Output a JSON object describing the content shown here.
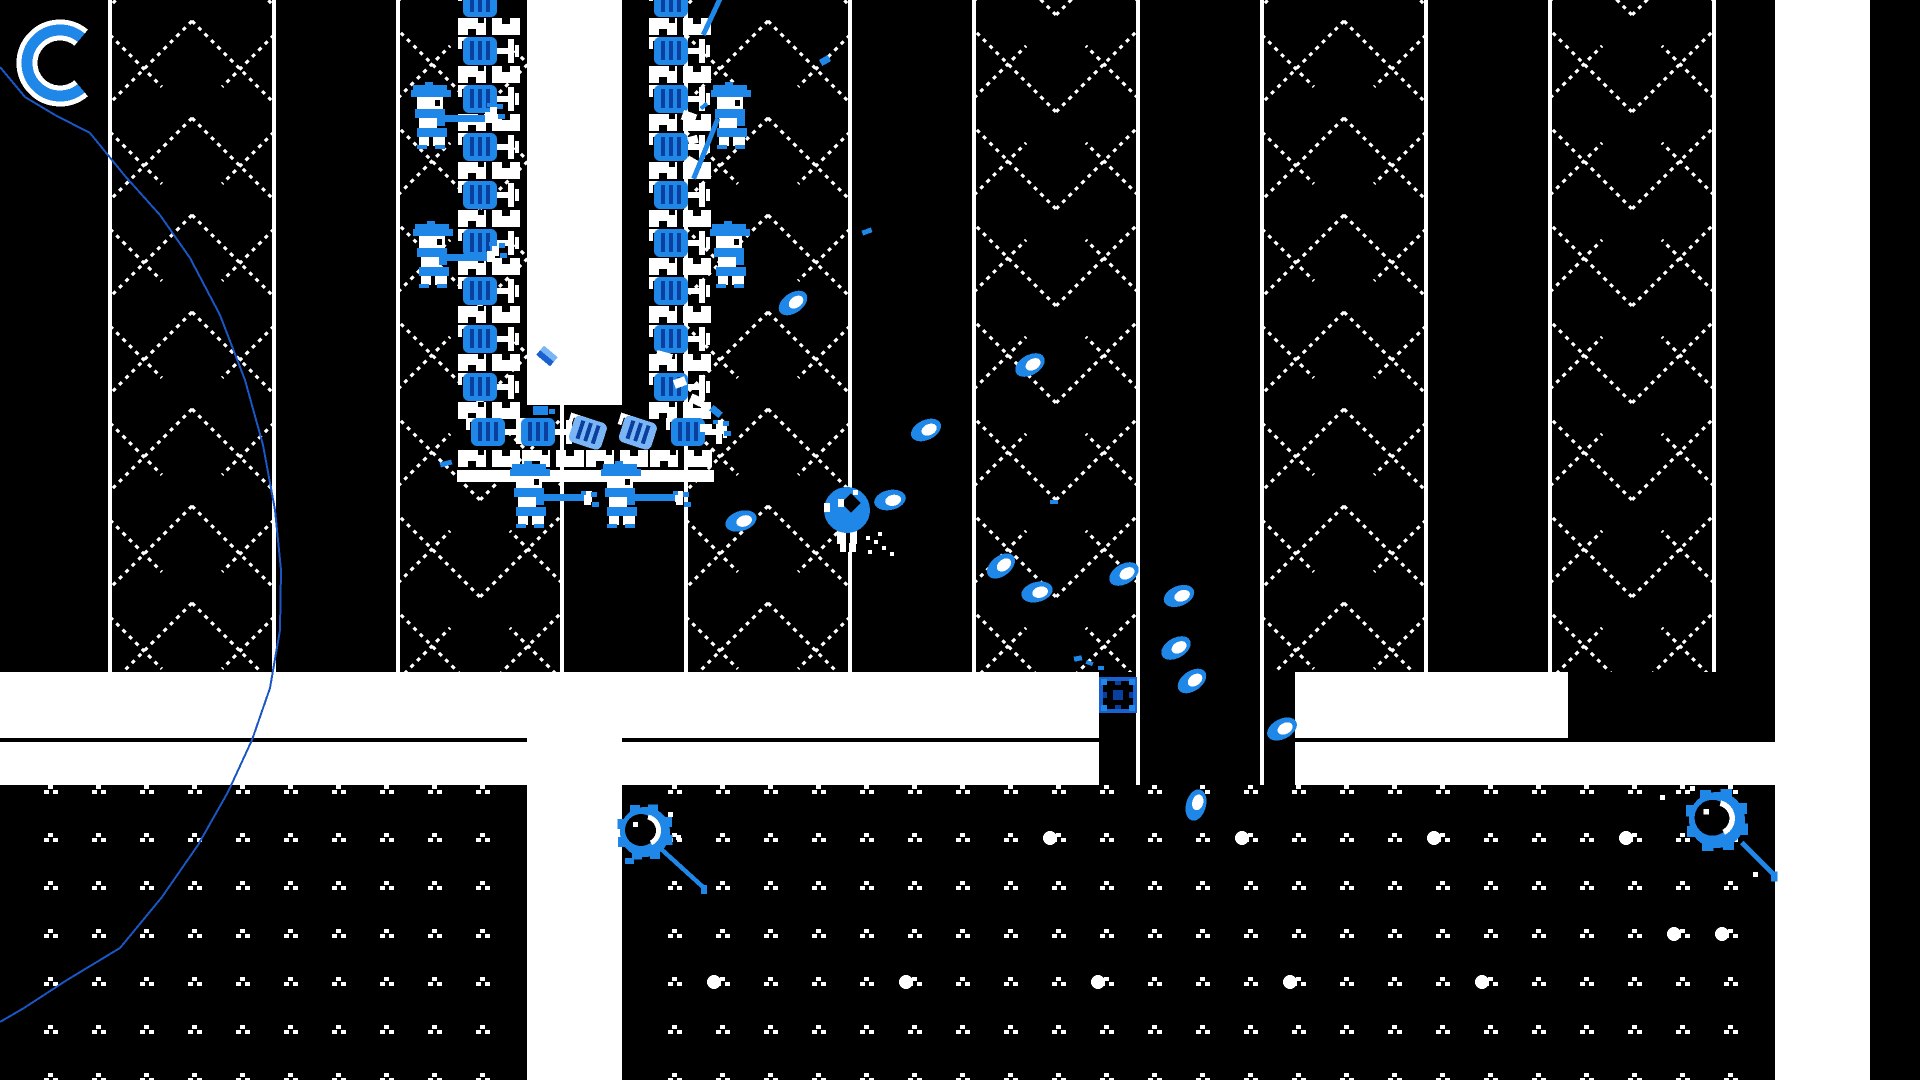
{
  "scene": {
    "width": 1920,
    "height": 1080,
    "bg": "#000000",
    "title": "pixel-art shooter game scene"
  },
  "palette": {
    "white": "#ffffff",
    "black": "#000000",
    "blue": "#1e87e8",
    "blue_dark": "#0a3f9e",
    "blue_mid": "#1861cf",
    "blue_light": "#7ab5f5",
    "line_blue": "#1a56c4"
  },
  "hud": {
    "dash_ring": {
      "cx": 60,
      "cy": 63,
      "r": 33,
      "a1": 50,
      "a2": 310,
      "outer_w": 21,
      "inner_w": 11
    }
  },
  "trajectory": {
    "points": [
      [
        0,
        67
      ],
      [
        25,
        97
      ],
      [
        55,
        115
      ],
      [
        90,
        133
      ],
      [
        125,
        176
      ],
      [
        160,
        215
      ],
      [
        190,
        258
      ],
      [
        220,
        315
      ],
      [
        245,
        380
      ],
      [
        263,
        445
      ],
      [
        275,
        510
      ],
      [
        281,
        570
      ],
      [
        280,
        630
      ],
      [
        270,
        688
      ],
      [
        252,
        740
      ],
      [
        228,
        792
      ],
      [
        198,
        845
      ],
      [
        162,
        897
      ],
      [
        120,
        948
      ],
      [
        67,
        980
      ],
      [
        24,
        1008
      ],
      [
        0,
        1022
      ]
    ]
  },
  "columns": {
    "width": 164,
    "bottom": 672,
    "tile_h": 97,
    "edge_w": 4,
    "items": [
      {
        "x": 110,
        "dir": "up",
        "eb": [
          672,
          672
        ]
      },
      {
        "x": 398,
        "dir": "down",
        "eb": [
          672,
          672
        ]
      },
      {
        "x": 686,
        "dir": "up",
        "eb": [
          672,
          672
        ]
      },
      {
        "x": 974,
        "dir": "down",
        "eb": [
          672,
          785
        ]
      },
      {
        "x": 1262,
        "dir": "up",
        "eb": [
          785,
          672
        ]
      },
      {
        "x": 1550,
        "dir": "down",
        "eb": [
          672,
          672
        ]
      }
    ]
  },
  "band": {
    "row1": {
      "y": 672,
      "h": 66,
      "segments": [
        [
          0,
          1099
        ],
        [
          1295,
          1568
        ]
      ]
    },
    "row2": {
      "y": 742,
      "h": 43,
      "segments": [
        [
          0,
          1099
        ],
        [
          1295,
          1870
        ]
      ]
    }
  },
  "corridors": [
    {
      "x": 527,
      "y": 672,
      "w": 95,
      "h": 408
    },
    {
      "x": 1775,
      "y": 0,
      "w": 95,
      "h": 1080
    }
  ],
  "ground": {
    "top": 785,
    "blocks": [
      [
        0,
        528
      ],
      [
        623,
        1776
      ]
    ],
    "pitch": 48,
    "x_phase": 2,
    "rows": [
      790,
      838,
      886,
      934,
      982,
      1030,
      1078
    ],
    "big_dots": [
      [
        1050,
        838
      ],
      [
        1242,
        838
      ],
      [
        1434,
        838
      ],
      [
        1626,
        838
      ],
      [
        714,
        982
      ],
      [
        906,
        982
      ],
      [
        1098,
        982
      ],
      [
        1290,
        982
      ],
      [
        1482,
        982
      ],
      [
        1674,
        934
      ],
      [
        1722,
        934
      ]
    ]
  },
  "fort": {
    "strip": {
      "x": 527,
      "y": 0,
      "w": 95,
      "h": 405
    },
    "walls": [
      {
        "x": 458,
        "units": 8
      },
      {
        "x": 649,
        "units": 8
      }
    ],
    "unit": {
      "period": 48,
      "castle_dy": -19,
      "dome_y0": 37
    },
    "bottom_row": {
      "y": 418,
      "turrets": [
        {
          "x": 466
        },
        {
          "x": 516
        },
        {
          "x": 566,
          "damaged": true
        },
        {
          "x": 616,
          "damaged": true
        },
        {
          "x": 666
        }
      ]
    },
    "base": {
      "castle_y": 450,
      "castle_xs": [
        458,
        522,
        586,
        650
      ],
      "bar": {
        "x": 457,
        "y": 470,
        "w": 257,
        "h": 12
      }
    },
    "knife": {
      "x": 538,
      "y": 350,
      "rot": 40
    }
  },
  "soldiers": [
    {
      "x": 411,
      "y": 85,
      "rifle": true
    },
    {
      "x": 413,
      "y": 224,
      "rifle": true
    },
    {
      "x": 510,
      "y": 464,
      "rifle": true
    },
    {
      "x": 601,
      "y": 464,
      "rifle": true
    },
    {
      "x": 711,
      "y": 85,
      "rifle": false
    },
    {
      "x": 710,
      "y": 224,
      "rifle": false
    }
  ],
  "muzzle_flashes": [
    [
      490,
      107
    ],
    [
      492,
      246
    ],
    [
      584,
      495
    ],
    [
      676,
      495
    ],
    [
      716,
      424
    ]
  ],
  "projectiles": [
    [
      793,
      303,
      -35
    ],
    [
      1030,
      365,
      -30
    ],
    [
      926,
      430,
      -25
    ],
    [
      890,
      500,
      -12
    ],
    [
      1001,
      566,
      -38
    ],
    [
      1037,
      592,
      -15
    ],
    [
      1124,
      574,
      -30
    ],
    [
      1179,
      596,
      -22
    ],
    [
      1176,
      648,
      -30
    ],
    [
      1192,
      681,
      -35
    ],
    [
      1282,
      729,
      -28
    ],
    [
      1196,
      805,
      -75
    ],
    [
      741,
      521,
      -18
    ]
  ],
  "streaks": [
    {
      "x": 716,
      "y": -2,
      "len": 40,
      "rot": 25
    },
    {
      "x": 714,
      "y": 118,
      "len": 65,
      "rot": 22
    }
  ],
  "debris_white": [
    [
      682,
      112,
      14,
      10,
      20
    ],
    [
      688,
      136,
      10,
      8,
      -15
    ],
    [
      686,
      158,
      12,
      9,
      30
    ],
    [
      656,
      352,
      16,
      10,
      15
    ],
    [
      674,
      378,
      12,
      9,
      -20
    ],
    [
      690,
      396,
      14,
      9,
      25
    ],
    [
      700,
      424,
      12,
      8,
      0
    ],
    [
      718,
      420,
      8,
      8,
      45
    ]
  ],
  "debris_blue": [
    [
      820,
      57,
      10,
      7,
      -30
    ],
    [
      862,
      229,
      10,
      5,
      -20
    ],
    [
      440,
      461,
      12,
      5,
      -15
    ],
    [
      533,
      406,
      15,
      9,
      0
    ],
    [
      549,
      409,
      6,
      5,
      0
    ],
    [
      1050,
      500,
      8,
      4,
      0
    ],
    [
      1074,
      656,
      8,
      5,
      -10
    ],
    [
      1086,
      661,
      7,
      4,
      20
    ],
    [
      1098,
      666,
      6,
      4,
      0
    ],
    [
      625,
      858,
      9,
      6,
      0
    ],
    [
      700,
      104,
      8,
      4,
      -40
    ],
    [
      710,
      408,
      12,
      7,
      40
    ]
  ],
  "player": {
    "cx": 847,
    "cy": 510,
    "r": 23,
    "trail": [
      [
        866,
        536
      ],
      [
        874,
        540
      ],
      [
        882,
        546
      ],
      [
        890,
        552
      ],
      [
        868,
        550
      ],
      [
        878,
        532
      ]
    ]
  },
  "saws": [
    {
      "cx": 645,
      "cy": 832,
      "scale": 1.0,
      "tail": [
        15,
        16,
        58,
        55
      ],
      "sparks": [
        [
          676,
          835
        ],
        [
          668,
          812
        ]
      ]
    },
    {
      "cx": 1717,
      "cy": 820,
      "scale": 1.12,
      "tail": [
        22,
        20,
        50,
        48
      ],
      "sparks": [
        [
          1660,
          795
        ],
        [
          1690,
          786
        ],
        [
          1753,
          872
        ]
      ]
    }
  ],
  "pickup_box": {
    "x": 1099,
    "y": 677,
    "w": 38,
    "h": 36
  }
}
